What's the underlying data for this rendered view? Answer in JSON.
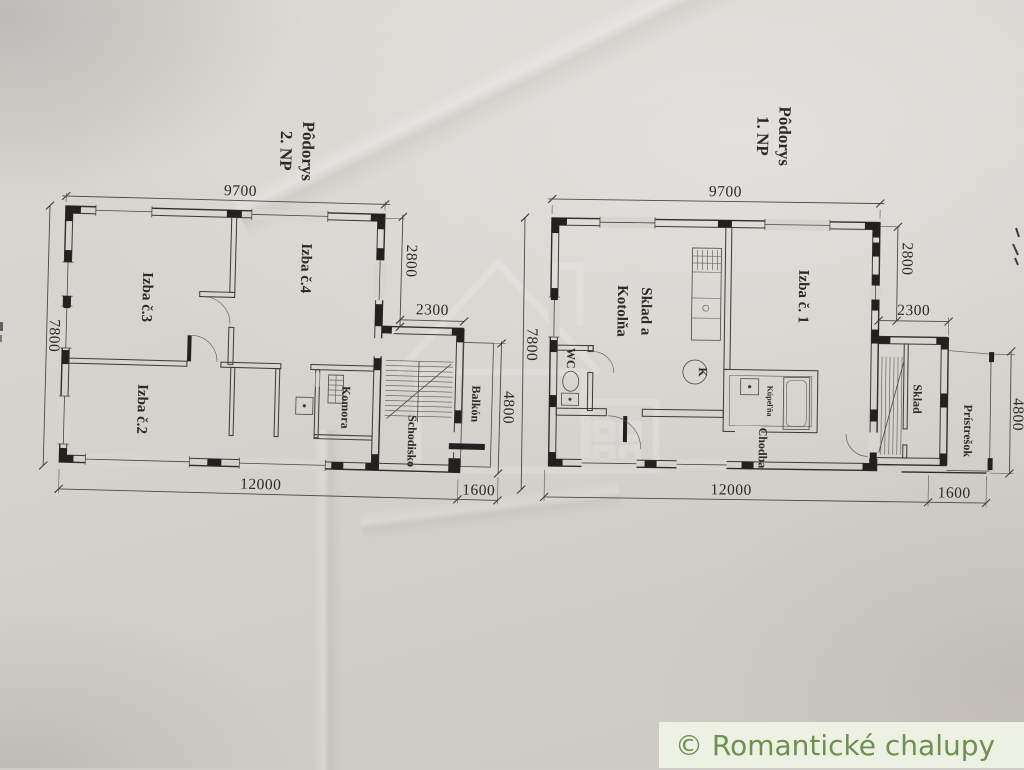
{
  "credit": {
    "label": "© Romantické chalupy",
    "text_color": "#6e9150",
    "bg_color": "#edf1e3"
  },
  "plans": {
    "left": {
      "title_line1": "Pôdorys",
      "title_line2": "2. NP",
      "rooms": {
        "izba3": "Izba č.3",
        "izba4": "Izba č.4",
        "izba2": "Izba č.2",
        "komora": "Komora",
        "schodisko": "Schodisko",
        "balkon": "Balkón"
      },
      "dims": {
        "top": "9700",
        "side_upper": "2800",
        "annex_width": "2300",
        "annex_height": "4800",
        "left": "7800",
        "bottom": "12000",
        "bottom_annex": "1600"
      }
    },
    "right": {
      "title_line1": "Pôdorys",
      "title_line2": "1. NP",
      "rooms": {
        "sklad_kotolna_1": "Sklad a",
        "sklad_kotolna_2": "Kotolňa",
        "izba1": "Izba č. 1",
        "wc": "WC",
        "kupelna": "Kúpeľňa",
        "chodba": "Chodba",
        "sklad": "Sklad",
        "pristresok": "Prístrešok",
        "boiler": "K"
      },
      "dims": {
        "top": "9700",
        "side_upper": "2800",
        "annex_width": "2300",
        "annex_height": "4800",
        "left": "7800",
        "bottom": "12000",
        "bottom_annex": "1600"
      }
    }
  }
}
